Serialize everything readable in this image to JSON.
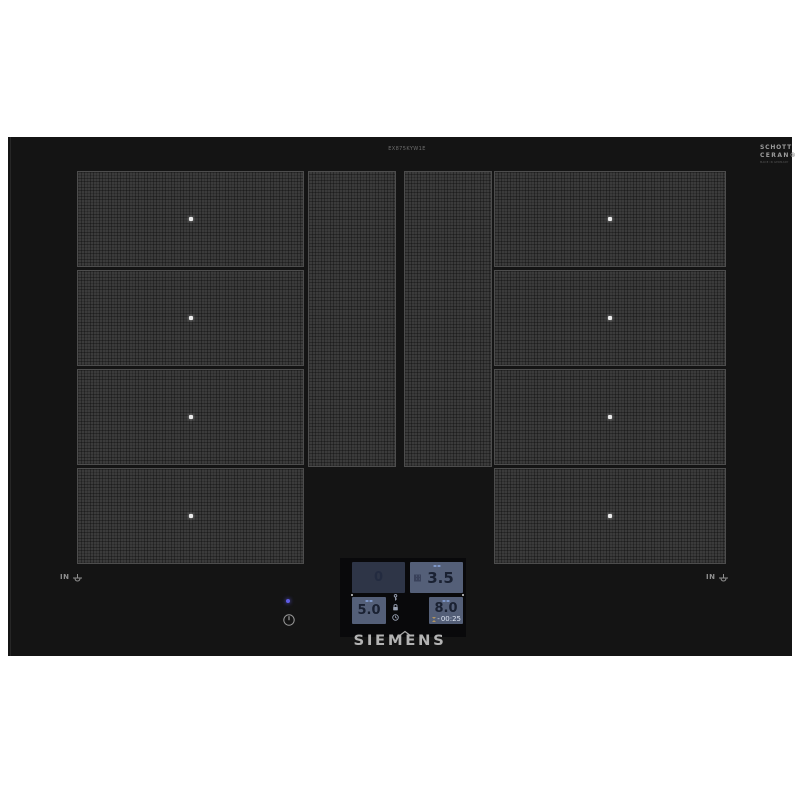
{
  "brand": {
    "siemens_logo": "SIEMENS",
    "model_text": "EX875KYW1E",
    "schott_line1": "SCHOTT",
    "schott_line2": "CERAN®",
    "schott_line3": "MADE IN GERMANY"
  },
  "glass": {
    "left_marking": "IN",
    "right_marking": "IN"
  },
  "display": {
    "top_left": {
      "value": "0"
    },
    "top_right": {
      "value": "3.5"
    },
    "bottom_left": {
      "value": "5.0"
    },
    "bottom_right": {
      "value": "8.0",
      "timer_prefix": "-",
      "timer": "00:25"
    }
  },
  "colors": {
    "glass_black": "#141414",
    "zone_fill": "#3b3b3b",
    "active_box_bg": "#545f78",
    "dim_box_bg": "#2e3547",
    "digit_color": "#1a2132",
    "timer_text": "#dde4f2",
    "power_led": "#5f5ce6",
    "background": "#ffffff"
  }
}
